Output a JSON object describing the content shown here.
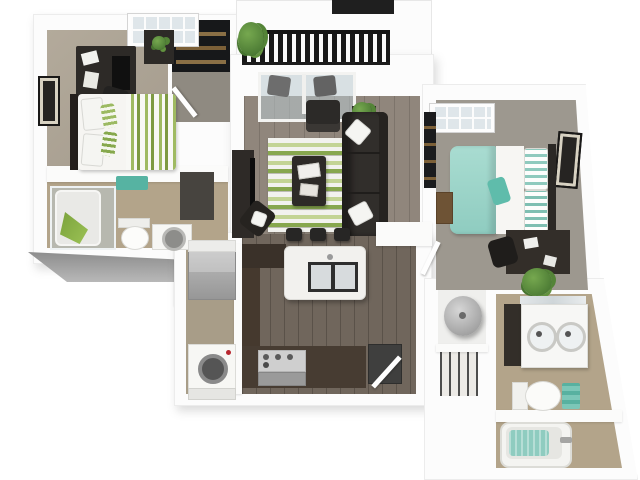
{
  "meta": {
    "content_type": "3d-isometric-floor-plan-render",
    "unit": "two-bedroom two-bath apartment with balcony",
    "visible_text": "none",
    "background": "#ffffff"
  },
  "palette": {
    "wall": "#fcfcfc",
    "wall_shade": "#b0b0b0",
    "slab_gray": "#979797",
    "wood_living": "#8b8177",
    "wood_kitchen": "#6b6157",
    "carpet_bed1": "#aba192",
    "carpet_bed2": "#9d988f",
    "tile_bath": "#b3a48a",
    "utility_floor": "#a89d88",
    "dark_furniture": "#2d2a27",
    "espresso": "#45392e",
    "accent_green": "#87a74e",
    "accent_green_light": "#c3d494",
    "accent_teal": "#8fccc0",
    "accent_teal_dark": "#56b3a2",
    "stainless": "#a8a8a8",
    "glass": "#c5cbd0",
    "railing_black": "#181818"
  },
  "rooms": [
    {
      "id": "bedroom-1",
      "area": "top-left",
      "floor": "tan carpet",
      "furniture": [
        "computer-desk",
        "desk-chair",
        "tv-on-desk",
        "nightstand-with-plant",
        "bed-green-striped-bedding",
        "framed-wall-art",
        "window",
        "entry-closet-shelves",
        "entry-door"
      ]
    },
    {
      "id": "bathroom-1",
      "area": "left-middle",
      "floor": "tan tile",
      "furniture": [
        "glass-shower-tub",
        "green-towel",
        "teal-bath-mat",
        "toilet",
        "sink-cabinet",
        "dark-cabinet"
      ]
    },
    {
      "id": "balcony",
      "area": "top-center",
      "floor": "white deck",
      "furniture": [
        "black-metal-railing",
        "potted-plant",
        "upper-railing-segment"
      ]
    },
    {
      "id": "living-room",
      "area": "center",
      "floor": "gray-brown plank",
      "furniture": [
        "sliding-glass-door-with-curtains",
        "armchair",
        "side-table-with-plant",
        "sectional-sofa",
        "white-throw-pillows",
        "green-striped-area-rug",
        "coffee-table-with-books",
        "tv-console",
        "corner-chair"
      ]
    },
    {
      "id": "kitchen",
      "area": "bottom-center",
      "floor": "dark plank",
      "furniture": [
        "island-with-double-sink",
        "three-bar-stools",
        "range-with-oven",
        "dark-counter-run",
        "dishwasher",
        "open-door"
      ]
    },
    {
      "id": "laundry-utility",
      "area": "bottom-left",
      "floor": "tan",
      "furniture": [
        "refrigerator",
        "washer-round-door",
        "dryer-counter",
        "upper-cabinet"
      ]
    },
    {
      "id": "bedroom-2",
      "area": "right",
      "floor": "gray carpet",
      "furniture": [
        "bed-teal-bedding",
        "striped-pillows",
        "framed-wall-art",
        "window",
        "desk",
        "desk-chair",
        "floor-plant",
        "wood-bench",
        "closet-shelves",
        "door"
      ]
    },
    {
      "id": "hall-closets",
      "area": "center-right",
      "furniture": [
        "water-heater-cylinder",
        "wire-shelf-closet"
      ]
    },
    {
      "id": "bathroom-2",
      "area": "bottom-right",
      "floor": "tan tile",
      "furniture": [
        "double-vanity-two-round-sinks",
        "mirror-strip",
        "toilet",
        "teal-towel-stack",
        "bathtub-with-teal-mat",
        "tub-faucet"
      ]
    }
  ]
}
